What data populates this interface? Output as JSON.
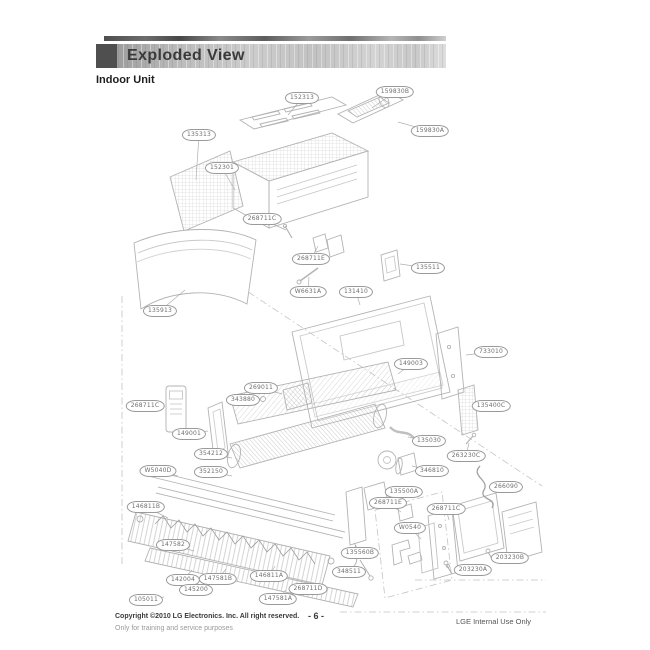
{
  "header": {
    "title": "Exploded View",
    "subtitle": "Indoor Unit"
  },
  "footer": {
    "copyright": "Copyright ©2010 LG Electronics. Inc. All right reserved.",
    "training_note": "Only for training and service purposes",
    "page_number": "- 6 -",
    "internal_note": "LGE Internal Use Only"
  },
  "colors": {
    "header_square": "#4f4f4f",
    "line_art": "#b3b3b3",
    "label_border": "#9a9a9a",
    "label_text": "#6f6f6f"
  },
  "diagram": {
    "labels": [
      {
        "text": "152313",
        "x": 302,
        "y": 98,
        "tx": 288,
        "ty": 115
      },
      {
        "text": "159830B",
        "x": 395,
        "y": 92,
        "tx": 372,
        "ty": 108
      },
      {
        "text": "159830A",
        "x": 430,
        "y": 131,
        "tx": 398,
        "ty": 122
      },
      {
        "text": "135313",
        "x": 199,
        "y": 135,
        "tx": 196,
        "ty": 180
      },
      {
        "text": "152301",
        "x": 222,
        "y": 168,
        "tx": 235,
        "ty": 190
      },
      {
        "text": "268711C",
        "x": 262,
        "y": 219,
        "tx": 286,
        "ty": 230
      },
      {
        "text": "268711E",
        "x": 311,
        "y": 259,
        "tx": 318,
        "ty": 246
      },
      {
        "text": "135511",
        "x": 428,
        "y": 268,
        "tx": 400,
        "ty": 264
      },
      {
        "text": "W6631A",
        "x": 308,
        "y": 292,
        "tx": 309,
        "ty": 277
      },
      {
        "text": "131410",
        "x": 356,
        "y": 292,
        "tx": 360,
        "ty": 305
      },
      {
        "text": "135913",
        "x": 160,
        "y": 311,
        "tx": 185,
        "ty": 290
      },
      {
        "text": "733010",
        "x": 491,
        "y": 352,
        "tx": 466,
        "ty": 355
      },
      {
        "text": "149003",
        "x": 411,
        "y": 364,
        "tx": 398,
        "ty": 374
      },
      {
        "text": "135400C",
        "x": 491,
        "y": 406,
        "tx": 479,
        "ty": 408
      },
      {
        "text": "269011",
        "x": 261,
        "y": 388,
        "tx": 282,
        "ty": 394
      },
      {
        "text": "343880",
        "x": 243,
        "y": 400,
        "tx": 260,
        "ty": 399
      },
      {
        "text": "268711C",
        "x": 145,
        "y": 406,
        "tx": 164,
        "ty": 406
      },
      {
        "text": "149001",
        "x": 189,
        "y": 434,
        "tx": 208,
        "ty": 431
      },
      {
        "text": "354212",
        "x": 211,
        "y": 454,
        "tx": 232,
        "ty": 458
      },
      {
        "text": "W5040D",
        "x": 158,
        "y": 471,
        "tx": 178,
        "ty": 476
      },
      {
        "text": "352150",
        "x": 211,
        "y": 472,
        "tx": 232,
        "ty": 476
      },
      {
        "text": "135030",
        "x": 429,
        "y": 441,
        "tx": 408,
        "ty": 437
      },
      {
        "text": "263230C",
        "x": 466,
        "y": 456,
        "tx": 469,
        "ty": 443
      },
      {
        "text": "346810",
        "x": 432,
        "y": 471,
        "tx": 412,
        "ty": 466
      },
      {
        "text": "135500A",
        "x": 404,
        "y": 492,
        "tx": 387,
        "ty": 496
      },
      {
        "text": "266090",
        "x": 506,
        "y": 487,
        "tx": 492,
        "ty": 489
      },
      {
        "text": "268711E",
        "x": 388,
        "y": 503,
        "tx": 401,
        "ty": 512
      },
      {
        "text": "268711C",
        "x": 446,
        "y": 509,
        "tx": 449,
        "ty": 520
      },
      {
        "text": "W0540",
        "x": 410,
        "y": 528,
        "tx": 421,
        "ty": 539
      },
      {
        "text": "146811B",
        "x": 146,
        "y": 507,
        "tx": 168,
        "ty": 518
      },
      {
        "text": "147582",
        "x": 173,
        "y": 545,
        "tx": 194,
        "ty": 551
      },
      {
        "text": "135560B",
        "x": 360,
        "y": 553,
        "tx": 354,
        "ty": 543
      },
      {
        "text": "348511",
        "x": 349,
        "y": 572,
        "tx": 366,
        "ty": 573
      },
      {
        "text": "142004",
        "x": 183,
        "y": 580,
        "tx": 192,
        "ty": 570
      },
      {
        "text": "147581B",
        "x": 218,
        "y": 579,
        "tx": 226,
        "ty": 569
      },
      {
        "text": "146811A",
        "x": 269,
        "y": 576,
        "tx": 275,
        "ty": 566
      },
      {
        "text": "145200",
        "x": 196,
        "y": 590,
        "tx": 213,
        "ty": 582
      },
      {
        "text": "105011",
        "x": 146,
        "y": 600,
        "tx": 164,
        "ty": 597
      },
      {
        "text": "147581A",
        "x": 278,
        "y": 599,
        "tx": 286,
        "ty": 590
      },
      {
        "text": "268711D",
        "x": 308,
        "y": 589,
        "tx": 296,
        "ty": 588
      },
      {
        "text": "203230B",
        "x": 510,
        "y": 558,
        "tx": 492,
        "ty": 561
      },
      {
        "text": "203230A",
        "x": 473,
        "y": 570,
        "tx": 455,
        "ty": 572
      }
    ]
  }
}
